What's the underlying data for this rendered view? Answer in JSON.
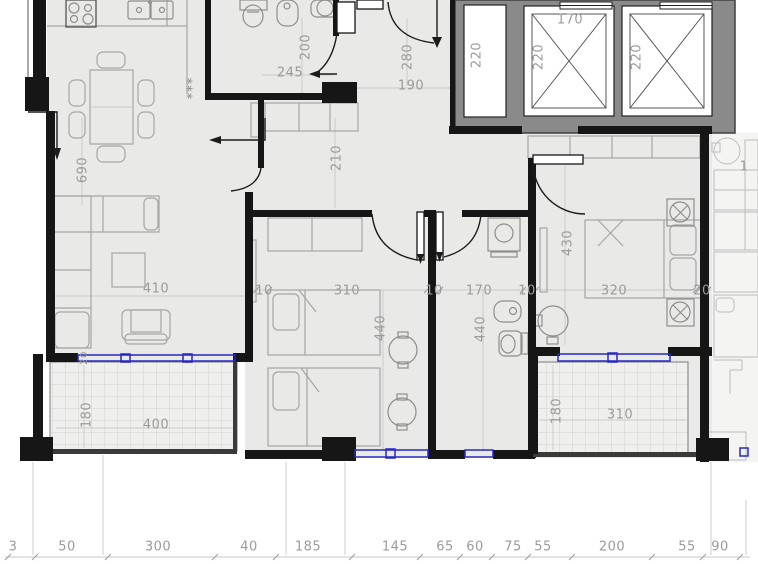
{
  "dims": {
    "v690": "690",
    "v200": "200",
    "v210": "210",
    "v280": "280",
    "v220_shaft": "220",
    "v220_car1": "220",
    "v220_car2": "220",
    "v430": "430",
    "v440_bedroom": "440",
    "v440_bath": "440",
    "v180_left": "180",
    "v180_right": "180",
    "v20_window": "20",
    "h245": "245",
    "h190": "190",
    "h170_elevator": "170",
    "h410": "410",
    "h10_a": "10",
    "h310_bedroom": "310",
    "h10_b": "10",
    "h170_bath": "170",
    "h10_c": "10",
    "h320": "320",
    "h20": "20",
    "h400": "400",
    "h310_balcony": "310",
    "h1_partial": "1",
    "bottom": {
      "b3": "3",
      "b50": "50",
      "b300": "300",
      "b40": "40",
      "b185": "185",
      "b145": "145",
      "b65": "65",
      "b60": "60",
      "b75": "75",
      "b55_a": "55",
      "b200": "200",
      "b55_b": "55",
      "b90": "90"
    }
  },
  "symbols": {
    "stars": "***"
  },
  "colors": {
    "wall": "#161616",
    "floor": "#e9e9e7",
    "elevator_gray": "#8a8a8a",
    "window_blue": "#2727c6",
    "dim_text": "#9b9b9b"
  }
}
